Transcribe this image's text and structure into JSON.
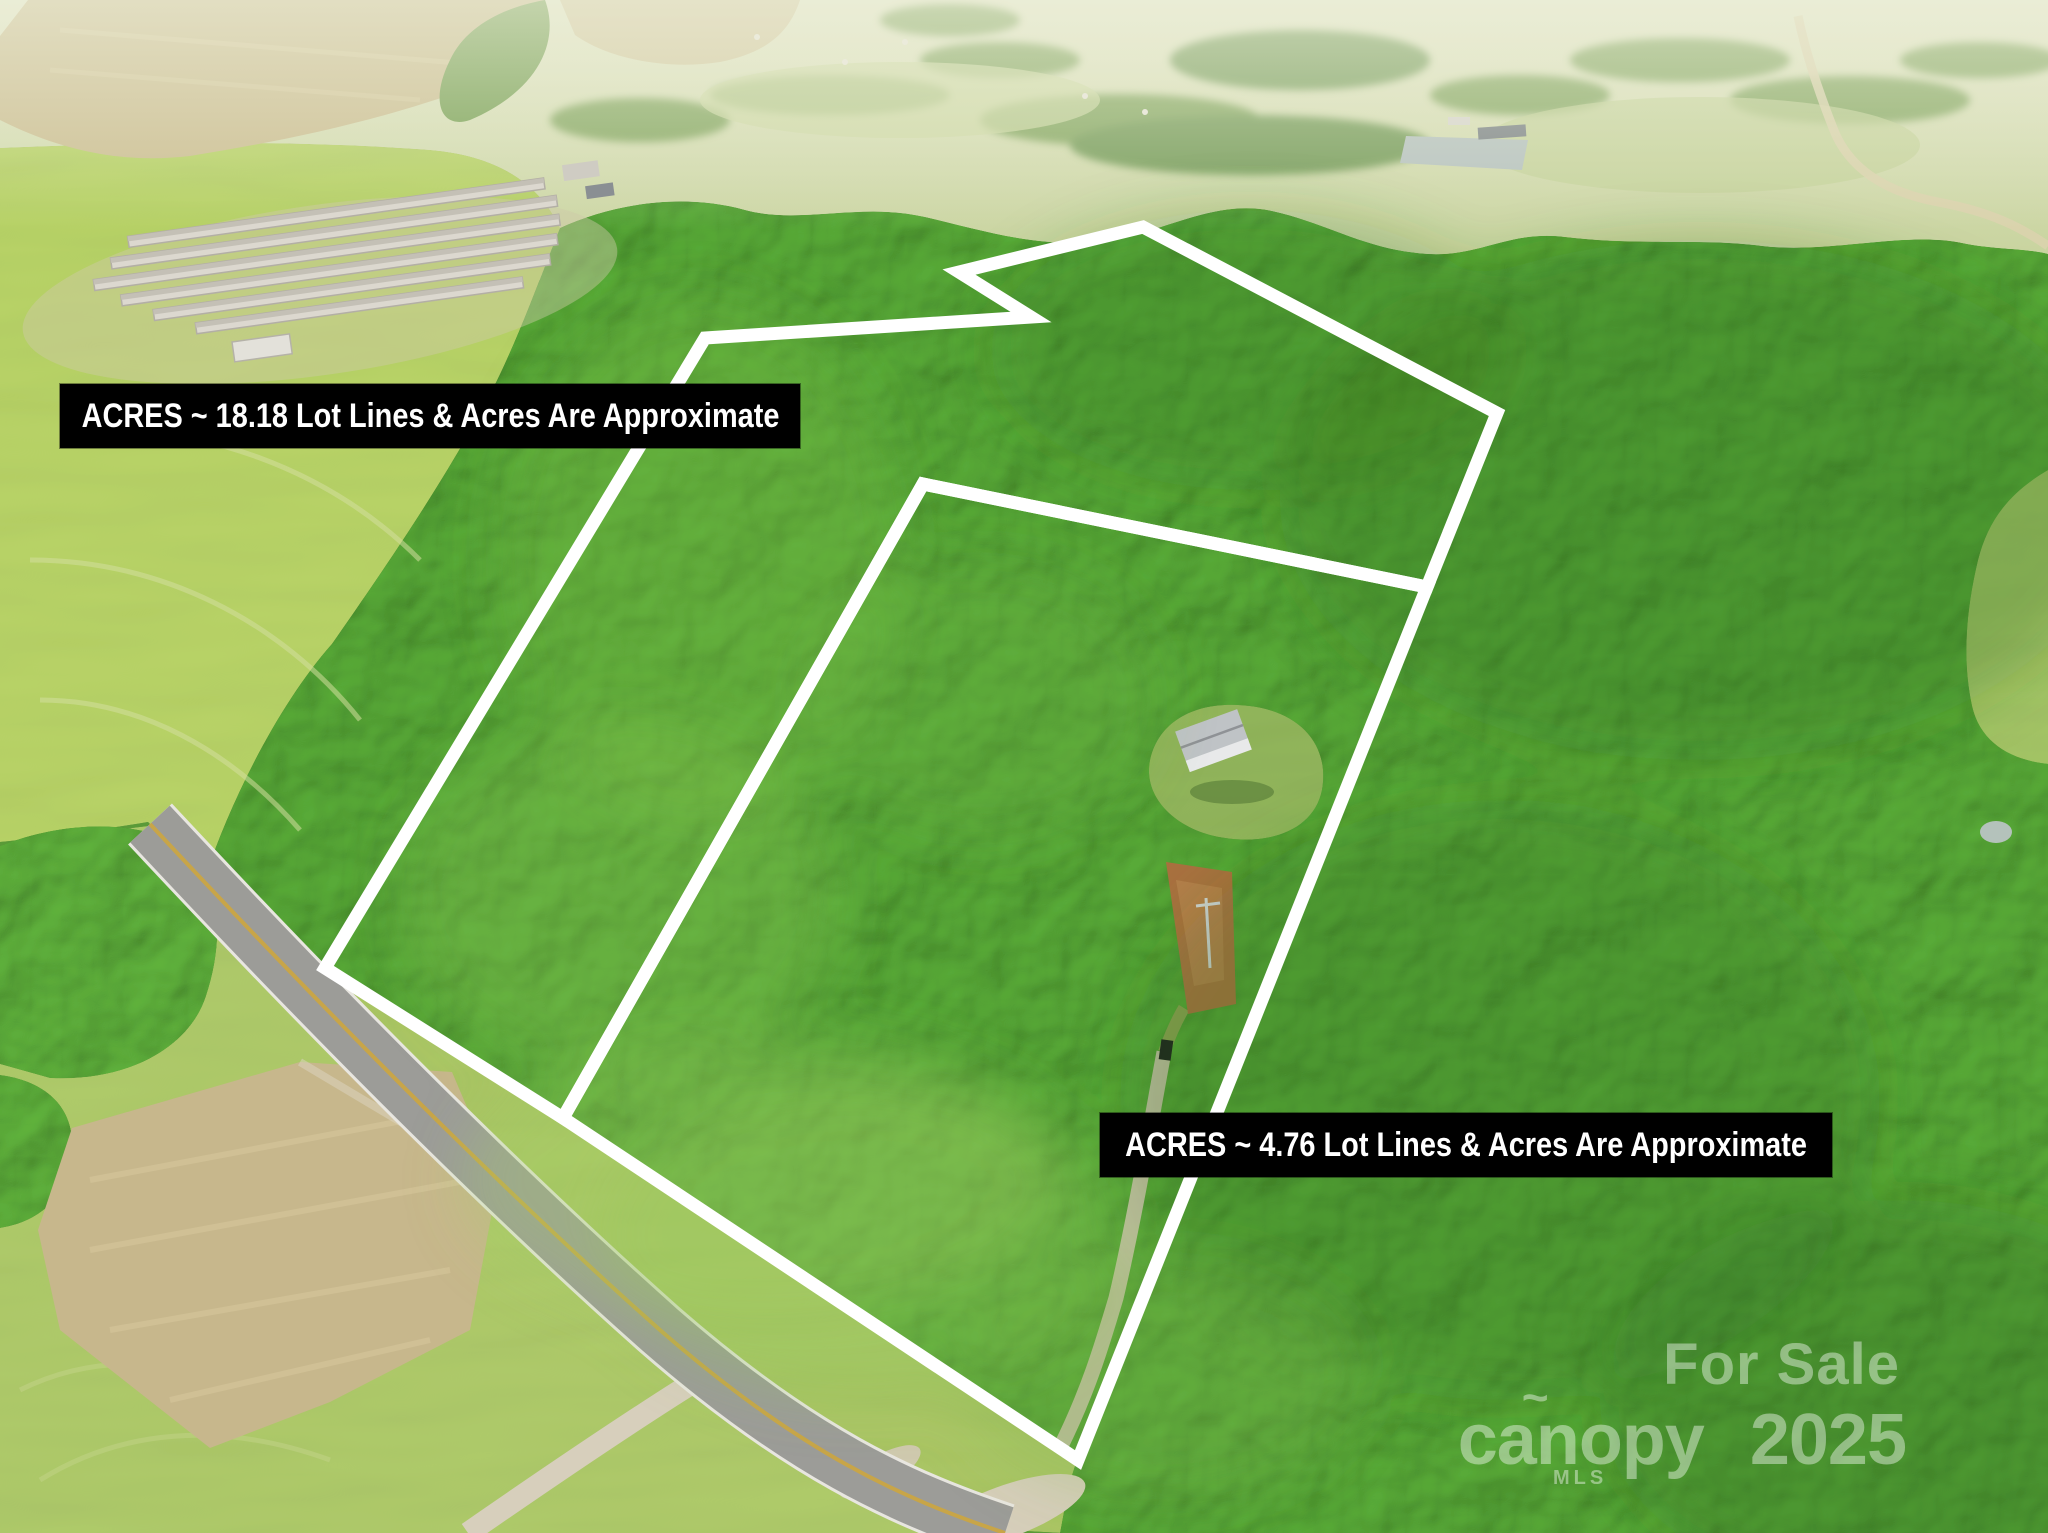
{
  "overlays": {
    "lot_large": {
      "label": "ACRES ~ 18.18 Lot Lines & Acres Are Approximate"
    },
    "lot_small": {
      "label": "ACRES ~ 4.76 Lot Lines & Acres Are Approximate"
    }
  },
  "watermark": {
    "line1": "For Sale",
    "brand": "canopy",
    "brand_mark": "~",
    "year": "2025",
    "mls": "MLS"
  },
  "colors": {
    "boundary_line": "#ffffff",
    "label_background": "#000000",
    "label_text": "#ffffff",
    "forest_green": "#4f9a31",
    "field_green": "#b2cc63",
    "road_gray": "#9c9c98"
  }
}
